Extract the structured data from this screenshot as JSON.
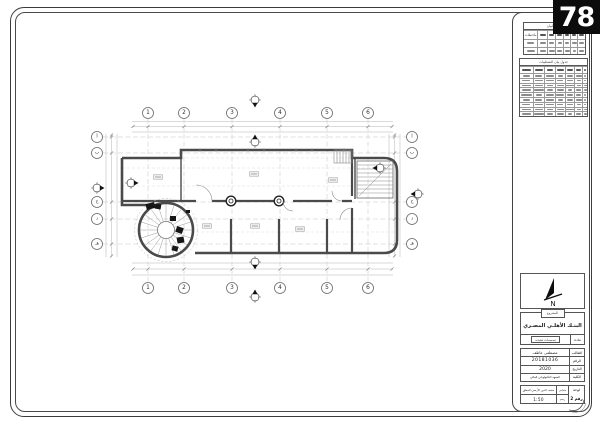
{
  "page_number": "78",
  "plan": {
    "grid_columns": [
      "1",
      "2",
      "3",
      "4",
      "5",
      "6"
    ],
    "grid_rows_left": [
      "أ",
      "ب",
      "ج",
      "د",
      "هـ"
    ],
    "grid_rows_right": [
      "أ",
      "ب",
      "ج",
      "د",
      "هـ"
    ]
  },
  "panel": {
    "data_table": {
      "title": "جدول البيان",
      "notes_header": "ملاحظات",
      "data_rows": 2,
      "columns": 7
    },
    "finish_table": {
      "title": "جدول بيان التشطيبات",
      "data_rows": 9,
      "columns": 7
    },
    "north": {
      "label": "N"
    },
    "project": {
      "tag": "المشروع",
      "name": "البنـك الأهلـي المصـري",
      "subject_label": "مادة",
      "subject_value": "تصميمات تنفيذية"
    },
    "info_rows": [
      {
        "label": "الطالب",
        "value": "مصطفى عاطف"
      },
      {
        "label": "الرقم",
        "value": "20181036"
      },
      {
        "label": "التاريخ",
        "value": "2020"
      },
      {
        "label": "الكلية",
        "value": "المعهد التكنولوجي العالي"
      }
    ],
    "sheet_box": {
      "sheet_label": "لوحة",
      "sheet_number": "رقم 2",
      "scale_label": "مقياس",
      "drawing_label": "رسم",
      "drawing_title": "سقف الدور الأرضي المعلق",
      "scale_value": "1:50"
    }
  }
}
